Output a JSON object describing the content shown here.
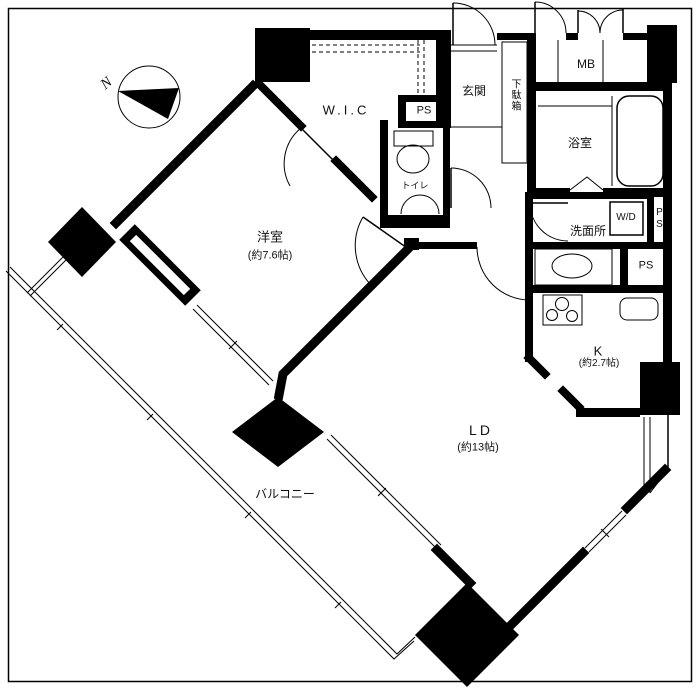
{
  "plan": {
    "compass_label": "N",
    "rooms": {
      "wic": {
        "name": "W.I.C"
      },
      "entrance": {
        "name": "玄関"
      },
      "shoe_cabinet": {
        "name": "下駄箱"
      },
      "meter_box": {
        "name": "MB"
      },
      "bathroom": {
        "name": "浴室"
      },
      "toilet": {
        "name": "トイレ"
      },
      "washroom": {
        "name": "洗面所"
      },
      "washer_dryer": {
        "name": "W/D"
      },
      "kitchen": {
        "name": "K",
        "size": "(約2.7帖)"
      },
      "living_dining": {
        "name": "LD",
        "size": "(約13帖)"
      },
      "western_room": {
        "name": "洋室",
        "size": "(約7.6帖)"
      },
      "balcony": {
        "name": "バルコニー"
      },
      "pipe_space_wic": {
        "name": "PS"
      },
      "pipe_space_washroom": {
        "name": "PS"
      },
      "pipe_space_lower": {
        "name": "PS"
      }
    },
    "colors": {
      "line": "#000000",
      "background": "#ffffff"
    }
  }
}
